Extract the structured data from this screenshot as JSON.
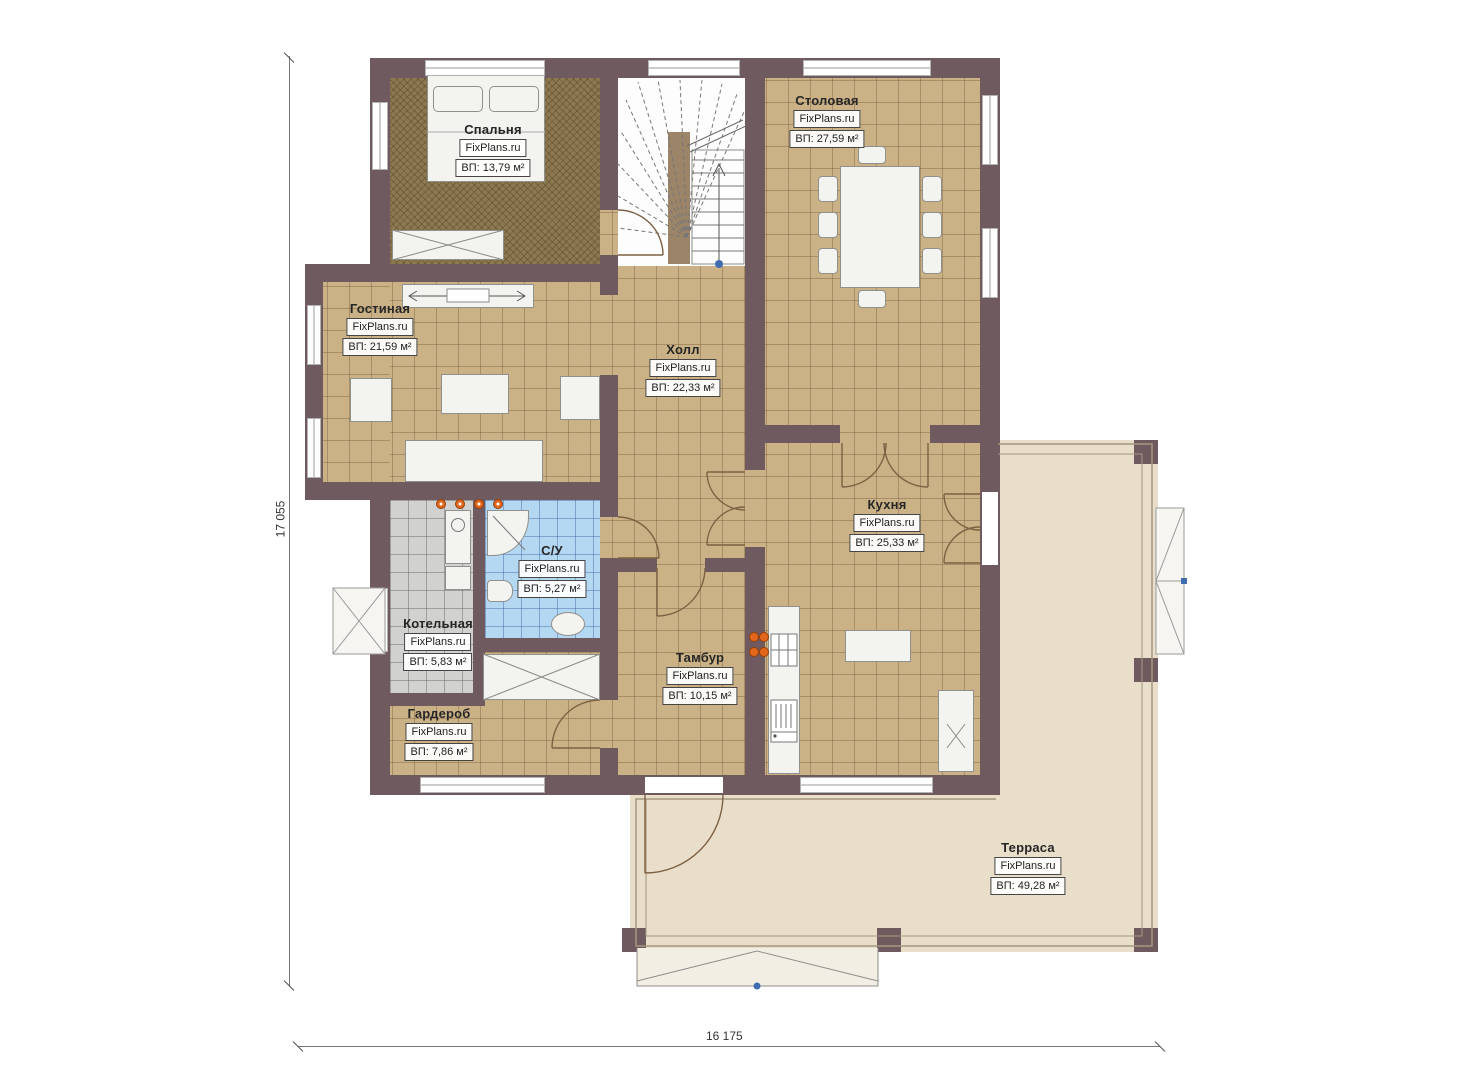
{
  "plan": {
    "rooms": [
      {
        "id": "bedroom",
        "name": "Спальня",
        "brand": "FixPlans.ru",
        "area": "ВП: 13,79 м²"
      },
      {
        "id": "dining",
        "name": "Столовая",
        "brand": "FixPlans.ru",
        "area": "ВП: 27,59 м²"
      },
      {
        "id": "living",
        "name": "Гостиная",
        "brand": "FixPlans.ru",
        "area": "ВП: 21,59 м²"
      },
      {
        "id": "hall",
        "name": "Холл",
        "brand": "FixPlans.ru",
        "area": "ВП: 22,33 м²"
      },
      {
        "id": "kitchen",
        "name": "Кухня",
        "brand": "FixPlans.ru",
        "area": "ВП: 25,33 м²"
      },
      {
        "id": "bathroom",
        "name": "С/У",
        "brand": "FixPlans.ru",
        "area": "ВП: 5,27 м²"
      },
      {
        "id": "boiler",
        "name": "Котельная",
        "brand": "FixPlans.ru",
        "area": "ВП: 5,83 м²"
      },
      {
        "id": "wardrobe",
        "name": "Гардероб",
        "brand": "FixPlans.ru",
        "area": "ВП: 7,86 м²"
      },
      {
        "id": "vestibule",
        "name": "Тамбур",
        "brand": "FixPlans.ru",
        "area": "ВП: 10,15 м²"
      },
      {
        "id": "terrace",
        "name": "Терраса",
        "brand": "FixPlans.ru",
        "area": "ВП: 49,28 м²"
      }
    ],
    "dimensions": {
      "left_total": "17 055",
      "bottom_total": "16 175"
    },
    "colors": {
      "wall": "#6f5b5f",
      "floor_tile": "#cbb186",
      "bedroom_carpet": "#8d7950",
      "bathroom_tile": "#b4d7f2",
      "boiler_tile": "#d1d1d0",
      "terrace": "#e8dec9",
      "burner_accent": "#e2661c",
      "marker_blue": "#3f6db0"
    }
  }
}
